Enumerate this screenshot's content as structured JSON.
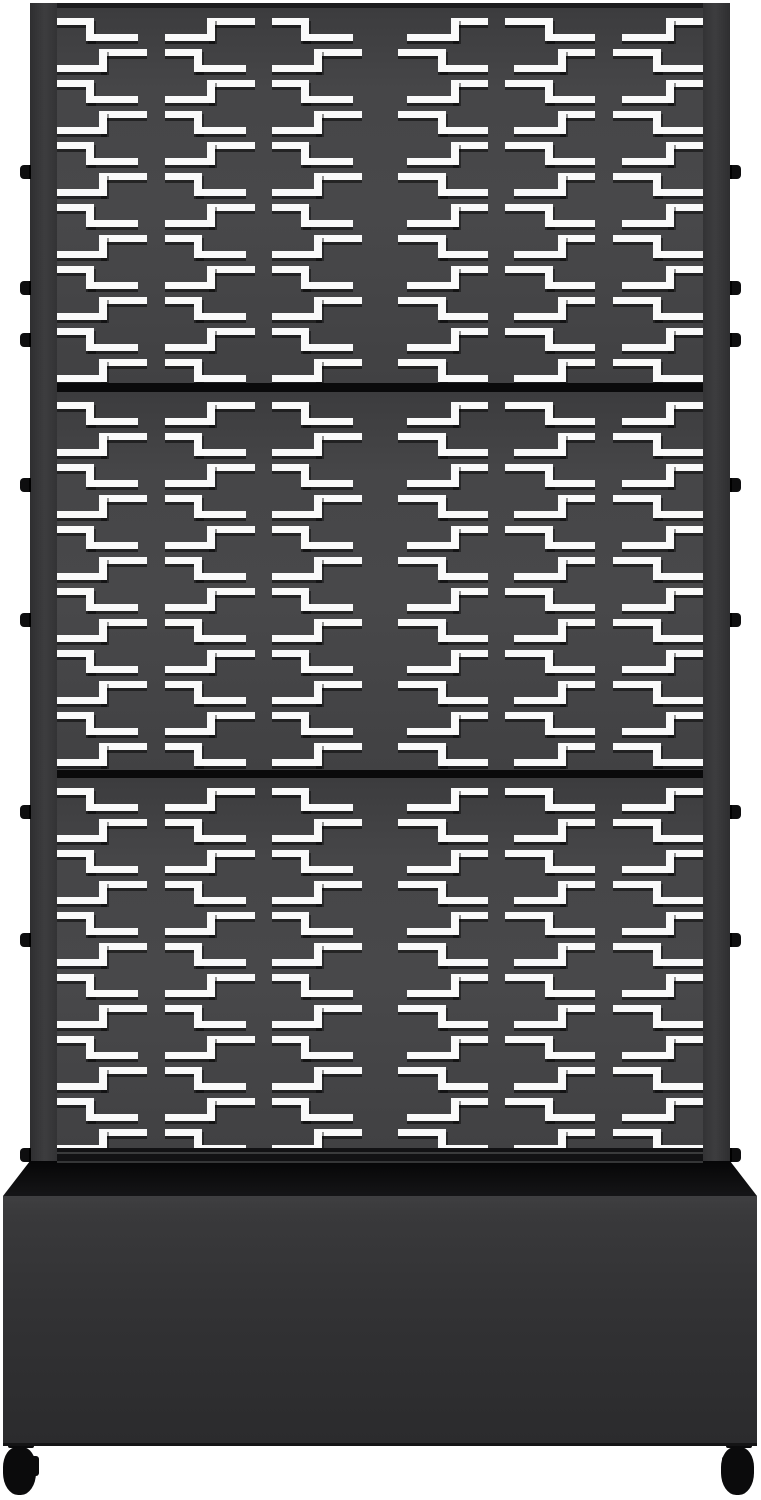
{
  "product": {
    "description": "Black metal outdoor privacy screen with laser-cut geometric cutout pattern, three stacked panels on a raised planter box with four swivel caster wheels, shown on a white background"
  },
  "colors": {
    "background": "#ffffff",
    "panel_face": "#48484a",
    "panel_face_edge": "#3c3c3e",
    "frame_post": "#39393b",
    "top_rail": "#1d1d1f",
    "separator": "#0a0a0b",
    "bottom_rail": "#121214",
    "rim_highlight": "#3a3b3c",
    "cutout": "#fafafa",
    "planter_top": "#0c0c0d",
    "planter_front": "#313133",
    "planter_front_light": "#3f3f41",
    "planter_bottom_edge": "#141415",
    "caster": "#0b0b0c",
    "knob": "#0e0e0f"
  },
  "screen": {
    "panels": [
      {
        "label": "upper-panel"
      },
      {
        "label": "middle-panel"
      },
      {
        "label": "lower-panel"
      }
    ],
    "pattern": {
      "panel_inner_width": 646,
      "columns": 6,
      "rows_per_panel": 12,
      "tile_width": 107.667,
      "row_pitch": 31,
      "top_offset": 10,
      "bar_thickness": 7,
      "shape_height": 23,
      "shape_a": {
        "top_bar": [
          0,
          37
        ],
        "vertical": [
          29,
          37
        ],
        "bottom_bar": [
          29,
          81
        ]
      },
      "shape_b": {
        "top_bar": [
          42,
          90
        ],
        "vertical": [
          42,
          50
        ],
        "bottom_bar": [
          0,
          50
        ]
      },
      "mirror_right_half": true
    },
    "knobs": {
      "y_centers": [
        172,
        288,
        340,
        485,
        620,
        812,
        940,
        1155
      ]
    }
  },
  "planter": {
    "top_width": 700,
    "front_width": 754,
    "wheel_count_visible": 2
  }
}
